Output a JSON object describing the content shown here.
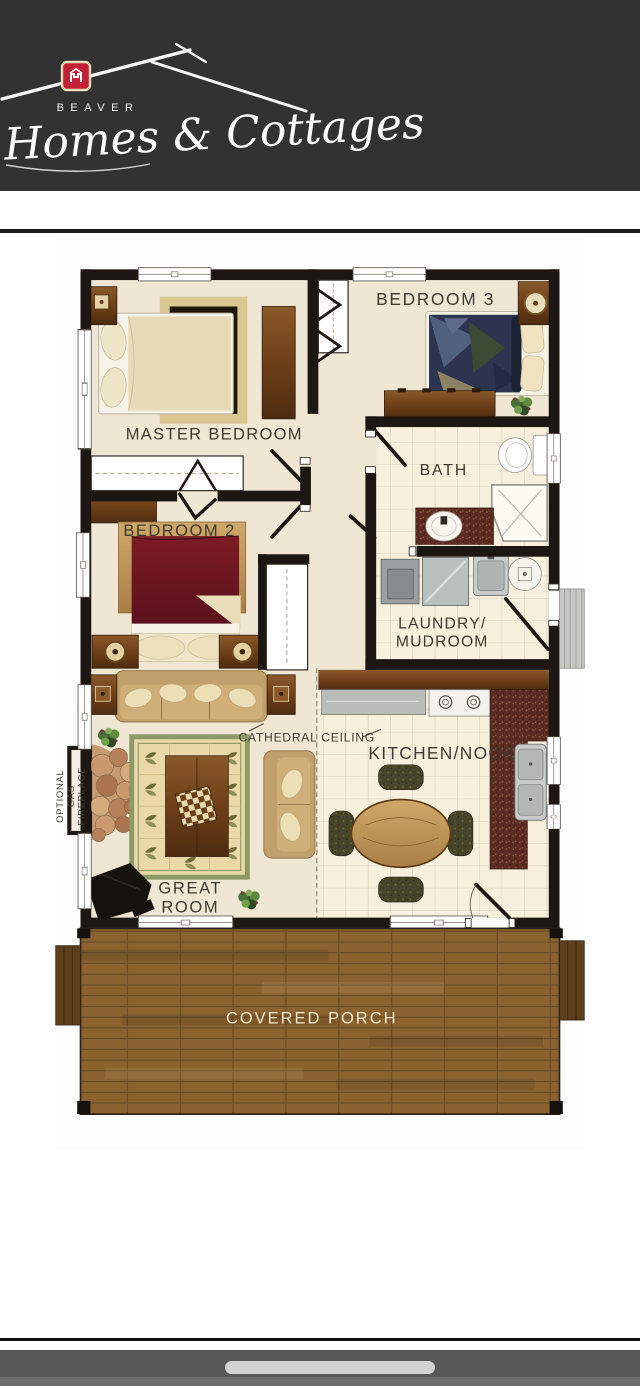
{
  "header": {
    "brand_word": "BEAVER",
    "brand_script": "Homes & Cottages",
    "emblem_icon": "home-hardware-mark",
    "colors": {
      "background": "#323232",
      "emblem_red": "#c32033",
      "text": "#f5f5f5"
    }
  },
  "floorplan": {
    "labels": {
      "bedroom3": "BEDROOM 3",
      "master_bedroom": "MASTER BEDROOM",
      "bath": "BATH",
      "bedroom2": "BEDROOM 2",
      "laundry_line1": "LAUNDRY/",
      "laundry_line2": "MUDROOM",
      "kitchen": "KITCHEN/NOOK",
      "great_line1": "GREAT",
      "great_line2": "ROOM",
      "cathedral": "CATHEDRAL CEILING",
      "fireplace_line1": "OPTIONAL",
      "fireplace_line2": "GAS",
      "fireplace_line3": "FIREPLACE",
      "porch": "COVERED PORCH"
    },
    "colors": {
      "wall": "#1c1713",
      "floor": "#efe7d4",
      "tile": "#f6f0dd",
      "porch_wood": "#8a6331",
      "label_ink": "#3f3a31",
      "porch_label": "#f2e8cc",
      "bed2_duvet": "#6a121c",
      "bed3_duvet": "#2c3450"
    }
  },
  "footer": {
    "home_indicator_icon": "drag-handle"
  }
}
